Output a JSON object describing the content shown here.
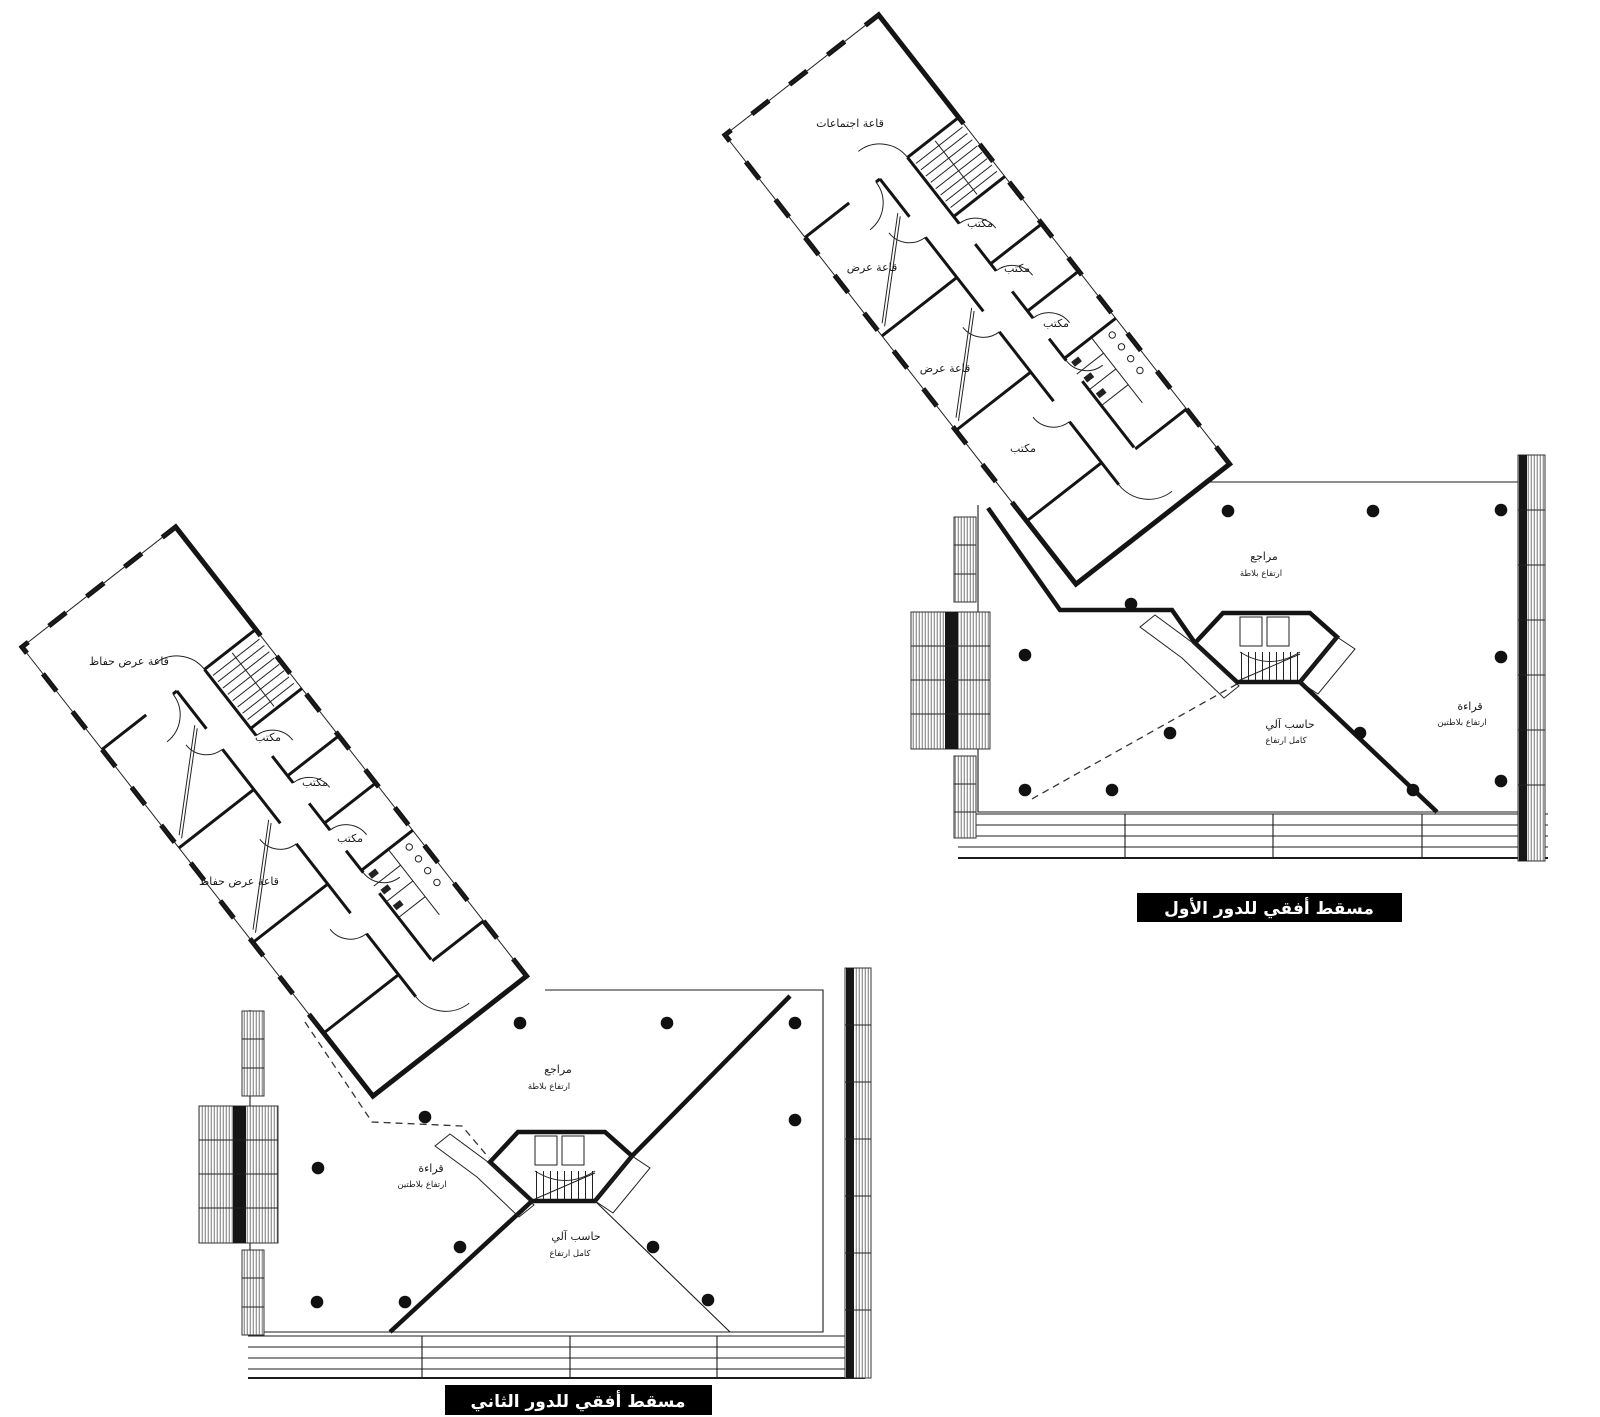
{
  "document": {
    "type": "architectural-floor-plans",
    "colors": {
      "paper": "#ffffff",
      "ink": "#141414",
      "title_bg": "#000000",
      "title_fg": "#ffffff"
    }
  },
  "floor1": {
    "title": "مسقط أفقي للدور الأول",
    "rooms": {
      "meeting_hall": "قاعة اجتماعات",
      "exhibition_1": "قاعة عرض",
      "exhibition_2": "قاعة عرض",
      "office_1": "مكتب",
      "office_2": "مكتب",
      "office_3": "مكتب",
      "office_4": "مكتب"
    },
    "zones": {
      "references": "مراجع",
      "references_note": "ارتفاع بلاطة",
      "computer": "حاسب آلي",
      "computer_note": "كامل ارتفاع",
      "reading": "قراءة",
      "reading_note": "ارتفاع بلاطتين"
    }
  },
  "floor2": {
    "title": "مسقط أفقي للدور الثاني",
    "rooms": {
      "preservation_hall_1": "قاعة عرض حفاظ",
      "preservation_hall_2": "قاعة عرض حفاظ",
      "office_1": "مكتب",
      "office_2": "مكتب",
      "office_3": "مكتب"
    },
    "zones": {
      "references": "مراجع",
      "references_note": "ارتفاع بلاطة",
      "computer": "حاسب آلي",
      "computer_note": "كامل ارتفاع",
      "reading": "قراءة",
      "reading_note": "ارتفاع بلاطتين"
    }
  }
}
